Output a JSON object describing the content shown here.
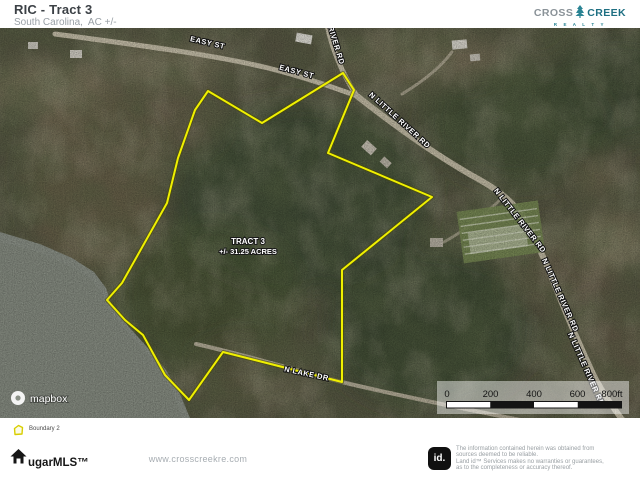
{
  "header": {
    "title": "RIC - Tract 3",
    "subtitle": "South Carolina,  AC +/-"
  },
  "brand": {
    "cross": "CROSS",
    "creek": "CREEK",
    "realty": "R E A L T Y"
  },
  "map": {
    "tract": {
      "line1": "TRACT 3",
      "line2": "+/- 31.25 ACRES"
    },
    "boundary_color": "#f0f000",
    "road_labels": [
      {
        "text": "EASY ST"
      },
      {
        "text": "EASY ST"
      },
      {
        "text": "RIVER RD"
      },
      {
        "text": "N LITTLE RIVER RD"
      },
      {
        "text": "N LITTLE RIVER RD"
      },
      {
        "text": "N LITTLE RIVER RD"
      },
      {
        "text": "N LITTLE RIVER RD"
      },
      {
        "text": "N LAKE DR"
      }
    ],
    "scale_bar": {
      "ticks": [
        "0",
        "200",
        "400",
        "600",
        "800ft"
      ]
    },
    "attribution": "mapbox"
  },
  "legend": {
    "items": [
      {
        "label": "Boundary 2",
        "color": "#d8ce00"
      }
    ]
  },
  "footer": {
    "mls_brand": "ugarMLS™",
    "website": "www.crosscreekre.com",
    "id_badge": "id.",
    "disclaimer_lines": [
      "The information contained herein was obtained from",
      "sources deemed to be reliable.",
      "Land id™ Services makes no warranties or guarantees,",
      "as to the completeness or accuracy thereof."
    ]
  }
}
